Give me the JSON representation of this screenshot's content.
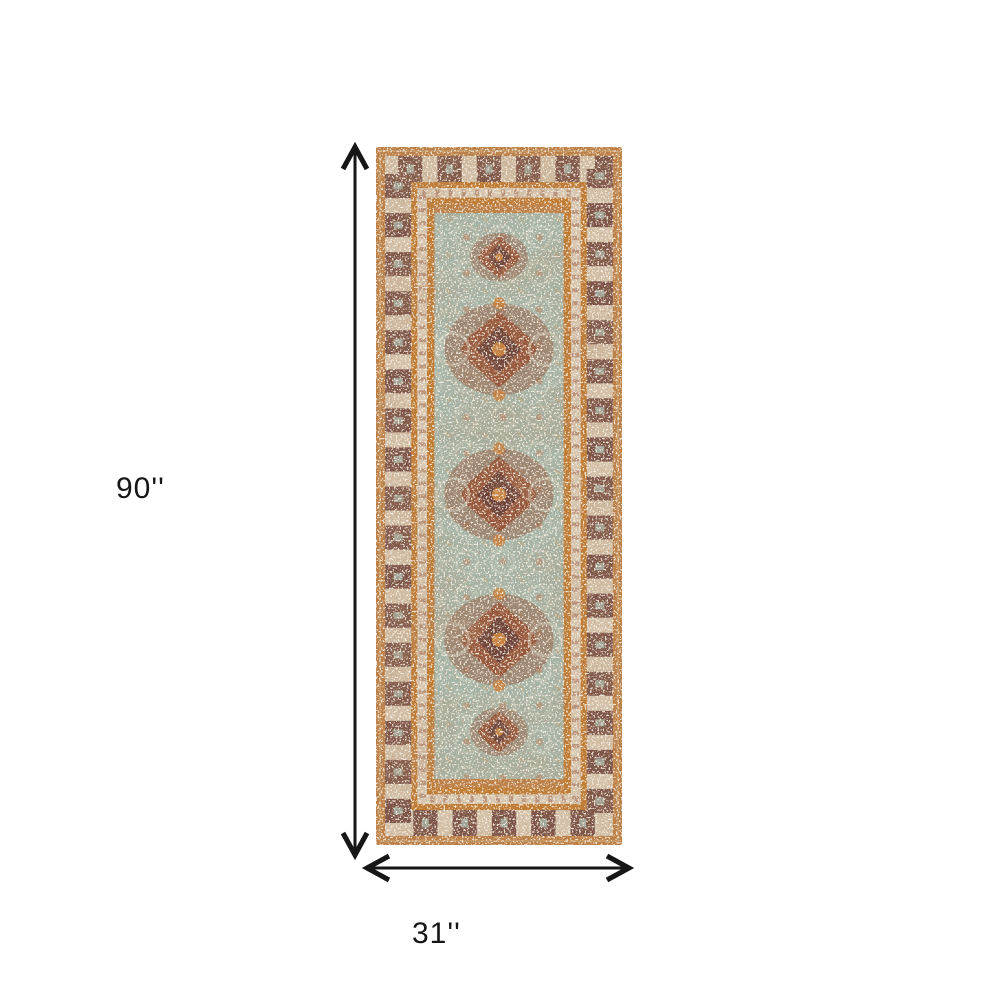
{
  "page": {
    "background_color": "#ffffff",
    "description": "Product dimension diagram of a runner rug"
  },
  "product_diagram": {
    "height_label": "90''",
    "width_label": "31''",
    "arrow_color": "#161616",
    "rug": {
      "style": "distressed vintage oriental runner rug",
      "colors": {
        "border_orange": "#bd7f45",
        "border_dark_brown": "#6d4237",
        "border_cream": "#d3c1a9",
        "guard_orange": "#c07b31",
        "field_sage": "#a6b4a6",
        "medallion_rust": "#96583c",
        "medallion_dark": "#6e4339",
        "accent_orange": "#c8823f",
        "speckle_cream": "#ece3d3"
      }
    }
  }
}
